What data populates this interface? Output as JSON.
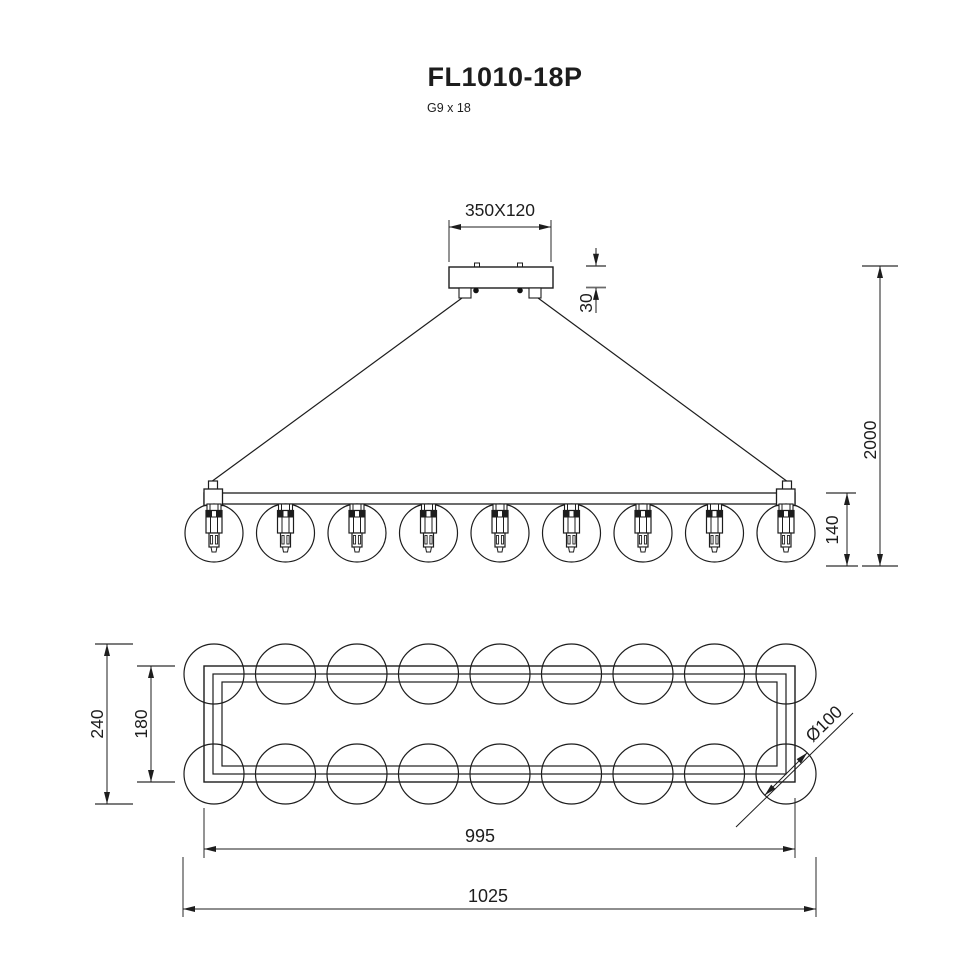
{
  "title": "FL1010-18P",
  "subtitle": "G9 x 18",
  "front_view": {
    "canopy_size": "350X120",
    "canopy_height": "30",
    "suspension_height": "2000",
    "fixture_height": "140",
    "bulb_count": 9
  },
  "top_view": {
    "overall_depth": "240",
    "frame_depth": "180",
    "globe_diameter": "Ø100",
    "frame_length": "995",
    "overall_length": "1025",
    "globe_count": 18
  }
}
